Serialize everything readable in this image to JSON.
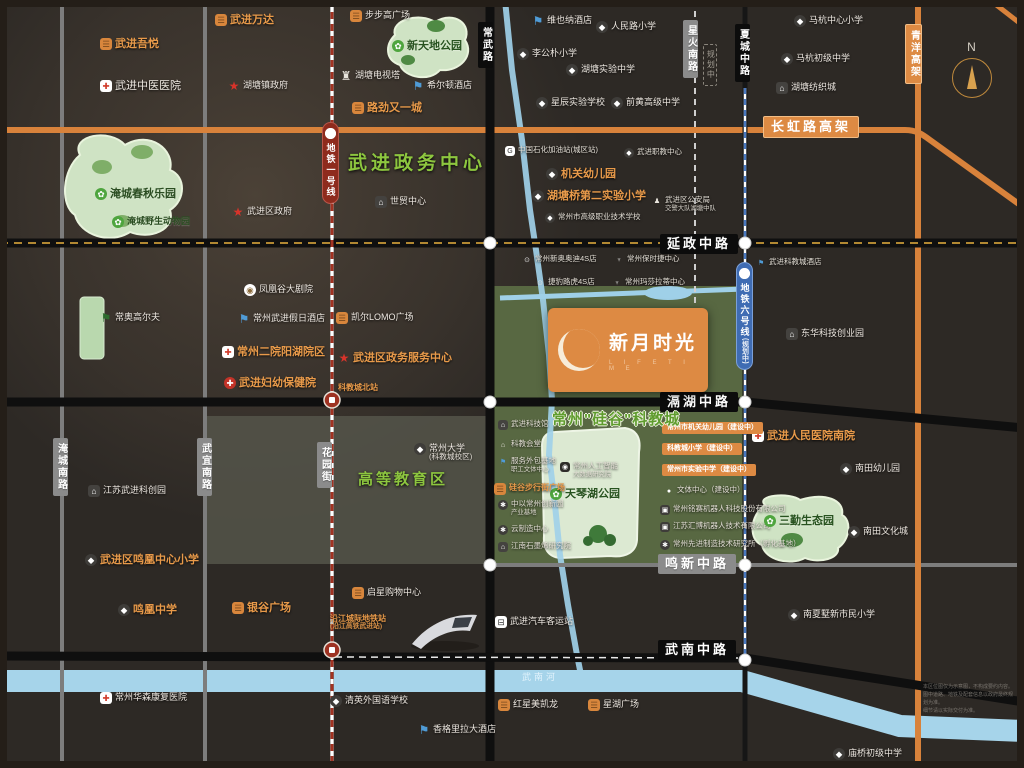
{
  "project": {
    "name": "新月时光",
    "tagline": "L I F E  T I M E"
  },
  "compass": "N",
  "colors": {
    "background": "#2d2925",
    "accent_orange": "#dd8a43",
    "accent_green": "#8dc63f",
    "metro1_red": "#a23322",
    "metro6_blue": "#4a79c0",
    "river_blue": "#9fd0e8",
    "road_black": "#0f0f0f",
    "road_gray": "#8b8b8b",
    "park_green": "#cfe3c4"
  },
  "zone_labels": [
    {
      "label": "武进政务中心",
      "x": 348,
      "y": 148,
      "cls": "z19"
    },
    {
      "label": "高等教育区",
      "x": 358,
      "y": 468,
      "cls": "z15"
    },
    {
      "label": "常州\"硅谷\"科教城",
      "x": 552,
      "y": 408,
      "cls": "z-outline"
    }
  ],
  "road_badges": [
    {
      "label": "常武路",
      "x": 478,
      "y": 22,
      "vert": true,
      "cls": "black"
    },
    {
      "label": "星火南路",
      "x": 683,
      "y": 20,
      "vert": true,
      "cls": "gray"
    },
    {
      "label": "规划中",
      "x": 703,
      "y": 44,
      "vert": true,
      "cls": "ghost"
    },
    {
      "label": "夏城中路",
      "x": 735,
      "y": 24,
      "vert": true,
      "cls": "black"
    },
    {
      "label": "青洋高架",
      "x": 905,
      "y": 24,
      "vert": true,
      "cls": "orangeb"
    },
    {
      "label": "长虹路高架",
      "x": 763,
      "y": 116,
      "vert": false,
      "cls": "orangeb bigb"
    },
    {
      "label": "延政中路",
      "x": 660,
      "y": 234,
      "vert": false,
      "cls": "black bigb"
    },
    {
      "label": "滆湖中路",
      "x": 660,
      "y": 392,
      "vert": false,
      "cls": "black bigb"
    },
    {
      "label": "鸣新中路",
      "x": 658,
      "y": 554,
      "vert": false,
      "cls": "gray bigb"
    },
    {
      "label": "武南中路",
      "x": 658,
      "y": 640,
      "vert": false,
      "cls": "black bigb"
    },
    {
      "label": "淹城南路",
      "x": 53,
      "y": 438,
      "vert": true,
      "cls": "gray"
    },
    {
      "label": "武宜南路",
      "x": 197,
      "y": 438,
      "vert": true,
      "cls": "gray"
    },
    {
      "label": "花园街",
      "x": 317,
      "y": 442,
      "vert": true,
      "cls": "gray"
    },
    {
      "label": "地铁一号线",
      "x": 322,
      "y": 122,
      "vert": true,
      "cls": "metro1",
      "logo": true
    },
    {
      "label": "地铁六号线",
      "sub": "(规划中)",
      "x": 736,
      "y": 262,
      "vert": true,
      "cls": "metro6",
      "logo": true
    }
  ],
  "pois": [
    {
      "label": "武进吾悦",
      "x": 100,
      "y": 38,
      "icon": "shop",
      "cls": "orange big"
    },
    {
      "label": "武进万达",
      "x": 215,
      "y": 14,
      "icon": "shop",
      "cls": "orange big"
    },
    {
      "label": "武进中医医院",
      "x": 100,
      "y": 80,
      "icon": "hospital",
      "cls": "big"
    },
    {
      "label": "湖塘镇政府",
      "x": 228,
      "y": 80,
      "icon": "star",
      "cls": ""
    },
    {
      "label": "淹城春秋乐园",
      "x": 95,
      "y": 188,
      "icon": "park",
      "cls": "dark big"
    },
    {
      "label": "淹城野生动物园",
      "x": 112,
      "y": 216,
      "icon": "park",
      "cls": "dark"
    },
    {
      "label": "武进区政府",
      "x": 232,
      "y": 206,
      "icon": "star",
      "cls": ""
    },
    {
      "label": "步步高广场",
      "x": 350,
      "y": 10,
      "icon": "shop",
      "cls": ""
    },
    {
      "label": "新天地公园",
      "x": 392,
      "y": 40,
      "icon": "park",
      "cls": "park-label big"
    },
    {
      "label": "湖塘电视塔",
      "x": 340,
      "y": 70,
      "icon": "tower",
      "cls": ""
    },
    {
      "label": "希尔顿酒店",
      "x": 412,
      "y": 80,
      "icon": "hotel",
      "cls": ""
    },
    {
      "label": "路劲又一城",
      "x": 352,
      "y": 102,
      "icon": "shop",
      "cls": "orange big"
    },
    {
      "label": "世贸中心",
      "x": 375,
      "y": 196,
      "icon": "building",
      "cls": ""
    },
    {
      "label": "维也纳酒店",
      "x": 532,
      "y": 15,
      "icon": "hotel",
      "cls": ""
    },
    {
      "label": "人民路小学",
      "x": 596,
      "y": 21,
      "icon": "school",
      "cls": ""
    },
    {
      "label": "李公朴小学",
      "x": 517,
      "y": 48,
      "icon": "school",
      "cls": ""
    },
    {
      "label": "湖塘实验中学",
      "x": 566,
      "y": 64,
      "icon": "school",
      "cls": ""
    },
    {
      "label": "星辰实验学校",
      "x": 536,
      "y": 97,
      "icon": "school",
      "cls": ""
    },
    {
      "label": "前黄高级中学",
      "x": 611,
      "y": 97,
      "icon": "school",
      "cls": ""
    },
    {
      "label": "中国石化加油站(城区站)",
      "x": 505,
      "y": 146,
      "icon": "gas",
      "cls": "white-tiny"
    },
    {
      "label": "武进职教中心",
      "x": 624,
      "y": 148,
      "icon": "school",
      "cls": "white-tiny"
    },
    {
      "label": "机关幼儿园",
      "x": 546,
      "y": 168,
      "icon": "school",
      "cls": "orange big"
    },
    {
      "label": "湖塘桥第二实验小学",
      "x": 532,
      "y": 190,
      "icon": "school",
      "cls": "orange big"
    },
    {
      "label": "常州市高级职业技术学校",
      "x": 545,
      "y": 213,
      "icon": "school",
      "cls": "white-tiny"
    },
    {
      "label": "武进区公安局",
      "sub": "交警大队湖塘中队",
      "x": 652,
      "y": 196,
      "icon": "police",
      "cls": "white-tiny"
    },
    {
      "label": "马杭中心小学",
      "x": 794,
      "y": 15,
      "icon": "school",
      "cls": ""
    },
    {
      "label": "马杭初级中学",
      "x": 781,
      "y": 53,
      "icon": "school",
      "cls": ""
    },
    {
      "label": "湖塘纺织城",
      "x": 776,
      "y": 82,
      "icon": "building",
      "cls": ""
    },
    {
      "label": "常奥高尔夫",
      "x": 100,
      "y": 312,
      "icon": "golf",
      "cls": ""
    },
    {
      "label": "凤凰谷大剧院",
      "x": 244,
      "y": 284,
      "icon": "theater",
      "cls": ""
    },
    {
      "label": "常州武进假日酒店",
      "x": 238,
      "y": 313,
      "icon": "hotel",
      "cls": ""
    },
    {
      "label": "常州二院阳湖院区",
      "x": 222,
      "y": 346,
      "icon": "hospital",
      "cls": "orange big"
    },
    {
      "label": "武进妇幼保健院",
      "x": 224,
      "y": 377,
      "icon": "hospital2",
      "cls": "orange big"
    },
    {
      "label": "凯尔LOMO广场",
      "x": 336,
      "y": 312,
      "icon": "shop",
      "cls": ""
    },
    {
      "label": "武进区政务服务中心",
      "x": 338,
      "y": 352,
      "icon": "star",
      "cls": "orange big"
    },
    {
      "label": "科教城北站",
      "x": 338,
      "y": 383,
      "cls": "orange-tiny"
    },
    {
      "label": "常州新奥奥迪4S店",
      "x": 522,
      "y": 255,
      "icon": "car",
      "cls": "white-tiny"
    },
    {
      "label": "常州保时捷中心",
      "x": 614,
      "y": 255,
      "icon": "car2",
      "cls": "white-tiny"
    },
    {
      "label": "捷豹路虎4S店",
      "x": 535,
      "y": 278,
      "icon": "car",
      "cls": "white-tiny"
    },
    {
      "label": "常州玛莎拉蒂中心",
      "x": 612,
      "y": 278,
      "icon": "car2",
      "cls": "white-tiny"
    },
    {
      "label": "武进科教城酒店",
      "x": 756,
      "y": 258,
      "icon": "hotel",
      "cls": "white-tiny"
    },
    {
      "label": "东华科技创业园",
      "x": 786,
      "y": 328,
      "icon": "building",
      "cls": ""
    },
    {
      "label": "武进人民医院南院",
      "x": 752,
      "y": 430,
      "icon": "hospital",
      "cls": "orange big"
    },
    {
      "label": "南田幼儿园",
      "x": 840,
      "y": 463,
      "icon": "school",
      "cls": ""
    },
    {
      "label": "常州大学",
      "sub": "(科教城校区)",
      "x": 414,
      "y": 443,
      "icon": "school",
      "cls": ""
    },
    {
      "label": "常州人工智能",
      "sub": "大数据研究院",
      "x": 560,
      "y": 462,
      "icon": "ai",
      "cls": "white-tiny"
    },
    {
      "label": "天琴湖公园",
      "x": 550,
      "y": 488,
      "icon": "park",
      "cls": "park-label big"
    },
    {
      "label": "武进科技馆",
      "x": 498,
      "y": 420,
      "icon": "building",
      "cls": "white-tiny"
    },
    {
      "label": "科教会堂",
      "x": 498,
      "y": 440,
      "icon": "home",
      "cls": "white-tiny"
    },
    {
      "label": "服务外包基地",
      "sub": "职工文体中心",
      "x": 498,
      "y": 457,
      "icon": "hotel",
      "cls": "white-tiny"
    },
    {
      "label": "硅谷步行街广场",
      "x": 494,
      "y": 483,
      "icon": "shop",
      "cls": "orange-tiny"
    },
    {
      "label": "中以常州创新园",
      "sub": "产业基地",
      "x": 498,
      "y": 500,
      "icon": "gear",
      "cls": "white-tiny"
    },
    {
      "label": "云制造中心",
      "x": 498,
      "y": 525,
      "icon": "gear",
      "cls": "white-tiny"
    },
    {
      "label": "江南石墨烯研究院",
      "x": 498,
      "y": 542,
      "icon": "building",
      "cls": "white-tiny"
    },
    {
      "label": "常州市机关幼儿园（建设中）",
      "x": 662,
      "y": 422,
      "cls": "badge-orange"
    },
    {
      "label": "科教城小学（建设中）",
      "x": 662,
      "y": 443,
      "cls": "badge-orange"
    },
    {
      "label": "常州市实验中学（建设中）",
      "x": 662,
      "y": 464,
      "cls": "badge-orange"
    },
    {
      "label": "文体中心（建设中）",
      "x": 664,
      "y": 486,
      "icon": "dot",
      "cls": "white-tiny"
    },
    {
      "label": "常州铭赛机器人科技股份有限公司",
      "x": 660,
      "y": 505,
      "icon": "factory",
      "cls": "white-tiny"
    },
    {
      "label": "江苏汇博机器人技术有限公司",
      "x": 660,
      "y": 522,
      "icon": "factory",
      "cls": "white-tiny"
    },
    {
      "label": "常州先进制造技术研究所（孵化基地）",
      "x": 660,
      "y": 540,
      "icon": "gear",
      "cls": "white-tiny"
    },
    {
      "label": "三勤生态园",
      "x": 764,
      "y": 515,
      "icon": "park",
      "cls": "park-label big"
    },
    {
      "label": "南田文化城",
      "x": 848,
      "y": 526,
      "icon": "school",
      "cls": ""
    },
    {
      "label": "南夏墅新市民小学",
      "x": 788,
      "y": 609,
      "icon": "school",
      "cls": ""
    },
    {
      "label": "庙桥初级中学",
      "x": 833,
      "y": 748,
      "icon": "school",
      "cls": ""
    },
    {
      "label": "江苏武进科创园",
      "x": 88,
      "y": 485,
      "icon": "building",
      "cls": ""
    },
    {
      "label": "武进区鸣凰中心小学",
      "x": 85,
      "y": 554,
      "icon": "school",
      "cls": "orange big"
    },
    {
      "label": "鸣凰中学",
      "x": 118,
      "y": 604,
      "icon": "school",
      "cls": "orange big"
    },
    {
      "label": "银谷广场",
      "x": 232,
      "y": 602,
      "icon": "shop",
      "cls": "orange big"
    },
    {
      "label": "常州华森康复医院",
      "x": 100,
      "y": 692,
      "icon": "hospital",
      "cls": ""
    },
    {
      "label": "清英外国语学校",
      "x": 330,
      "y": 695,
      "icon": "school",
      "cls": ""
    },
    {
      "label": "香格里拉大酒店",
      "x": 418,
      "y": 724,
      "icon": "hotel",
      "cls": ""
    },
    {
      "label": "红星美凯龙",
      "x": 498,
      "y": 699,
      "icon": "shop",
      "cls": ""
    },
    {
      "label": "星湖广场",
      "x": 588,
      "y": 699,
      "icon": "shop",
      "cls": ""
    },
    {
      "label": "启星购物中心",
      "x": 352,
      "y": 587,
      "icon": "shop",
      "cls": ""
    },
    {
      "label": "沿江城际地铁站",
      "sub": "(沿江高铁武进站)",
      "x": 330,
      "y": 614,
      "cls": "orange-tiny"
    },
    {
      "label": "武进汽车客运站",
      "x": 495,
      "y": 616,
      "icon": "bus",
      "cls": ""
    },
    {
      "label": "武南河",
      "x": 522,
      "y": 672,
      "cls": "river"
    }
  ],
  "disclaimer": [
    "本区位图仅为示意图，不构成要约内容。",
    "图中道路、地铁及配套信息以政府最终规划为准。",
    "细节请以实际交付为准。"
  ]
}
